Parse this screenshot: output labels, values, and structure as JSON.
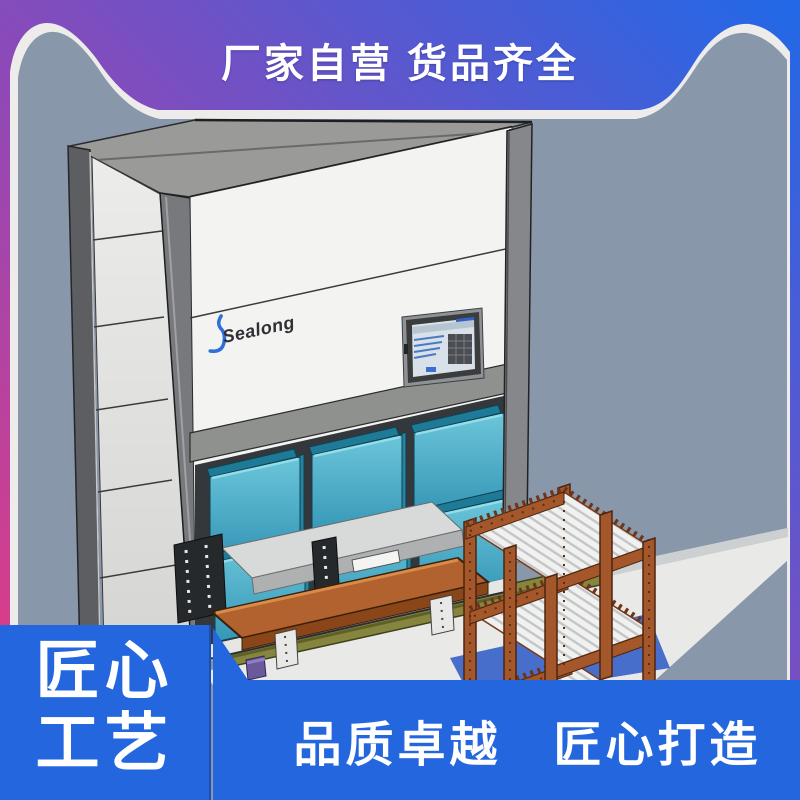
{
  "top_banner": {
    "text": "厂家自营 货品齐全",
    "text_color": "#ffffff"
  },
  "scene": {
    "background_color": "#8897aa",
    "machine_brand": "Sealong",
    "bin_color": "#3fa8c2",
    "cart_color": "#a3572a",
    "belt_color": "#85853e"
  },
  "badge": {
    "lines": [
      "匠心",
      "工艺"
    ],
    "bg": "#2366dd"
  },
  "bottom_banner": {
    "text": "品质卓越　匠心打造",
    "bg": "#2366dd"
  },
  "frame": {
    "gradient": [
      "#ee3a7c",
      "#8d49b8",
      "#2069e8"
    ]
  }
}
